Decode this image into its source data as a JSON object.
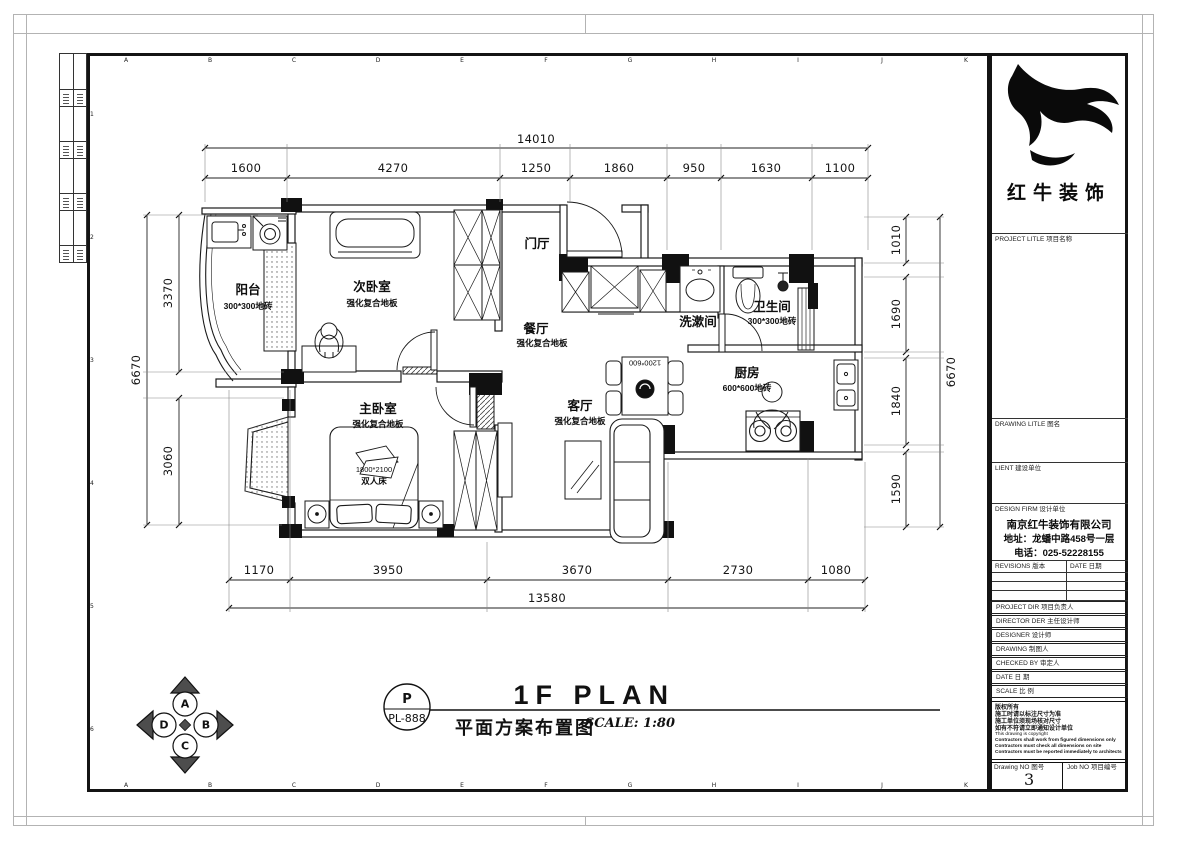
{
  "sheet": {
    "grid_letters_top": [
      "A",
      "B",
      "C",
      "D",
      "E",
      "F",
      "G",
      "H",
      "I",
      "J",
      "K"
    ],
    "grid_letters_bottom": [
      "A",
      "B",
      "C",
      "D",
      "E",
      "F",
      "G",
      "H",
      "I",
      "J",
      "K"
    ],
    "grid_numbers_left": [
      "1",
      "2",
      "3",
      "4",
      "5",
      "6"
    ]
  },
  "dims": {
    "top_total": "14010",
    "top": [
      "1600",
      "4270",
      "1250",
      "1860",
      "950",
      "1630",
      "1100"
    ],
    "bottom": [
      "1170",
      "3950",
      "3670",
      "2730",
      "1080"
    ],
    "bottom_total": "13580",
    "left": [
      "3370",
      "3060"
    ],
    "left_total": "6670",
    "right": [
      "1010",
      "1690",
      "1840",
      "1590"
    ],
    "right_total": "6670"
  },
  "plan": {
    "rooms": {
      "balcony": {
        "name": "阳台",
        "sub": "300*300地砖"
      },
      "second_bedroom": {
        "name": "次卧室",
        "sub": "强化复合地板"
      },
      "foyer": {
        "name": "门厅"
      },
      "dining": {
        "name": "餐厅",
        "sub": "强化复合地板"
      },
      "washroom": {
        "name": "洗漱间"
      },
      "bathroom": {
        "name": "卫生间",
        "sub": "300*300地砖"
      },
      "kitchen": {
        "name": "厨房",
        "sub": "600*600地砖"
      },
      "living": {
        "name": "客厅",
        "sub": "强化复合地板"
      },
      "master_bedroom": {
        "name": "主卧室",
        "sub": "强化复合地板"
      }
    },
    "furniture": {
      "bed_size": "1800*2100",
      "bed_type": "双人床",
      "table_size": "1200*600"
    }
  },
  "footer": {
    "ref_top": "P",
    "ref_bottom": "PL-888",
    "title_en": "1F PLAN",
    "title_cn": "平面方案布置图",
    "scale": "SCALE: 1:80"
  },
  "compass": {
    "top": "A",
    "right": "B",
    "bottom": "C",
    "left": "D"
  },
  "title_block": {
    "company_cn": "红牛装饰",
    "project_title_label": "PROJECT LITLE  项目名称",
    "drawing_title_label": "DRAWING LITLE  图名",
    "client_label": "LIENT  建设单位",
    "design_firm_label": "DESIGN FIRM  设计单位",
    "firm_name": "南京红牛装饰有限公司",
    "firm_address": "地址：龙蟠中路458号一层",
    "firm_phone": "电话：025-52228155",
    "revisions_label": "REVISIONS  版本",
    "date_col_label": "DATE  日期",
    "rows": {
      "project_dir": "PROJECT DIR   项目负责人",
      "director": "DIRECTOR DER 主任设计师",
      "designer": "DESIGNER      设计师",
      "drawing_by": "DRAWING      制图人",
      "checked_by": "CHECKED BY  审定人",
      "date": "DATE             日  期",
      "scale": "SCALE            比  例"
    },
    "copyright_lines": [
      "版权所有",
      "施工时请以标注尺寸为准",
      "施工单位须现场核对尺寸",
      "如有不符请立即通知设计单位",
      "This drawing is copyright",
      "Contractors shall work from figured dimensions only",
      "Contractors must check all dimensions on site",
      "Contractors must be reported immediately to architects"
    ],
    "drawing_no_label": "Drawing NO  图号",
    "drawing_no": "3",
    "job_no_label": "Job NO  项目编号"
  }
}
